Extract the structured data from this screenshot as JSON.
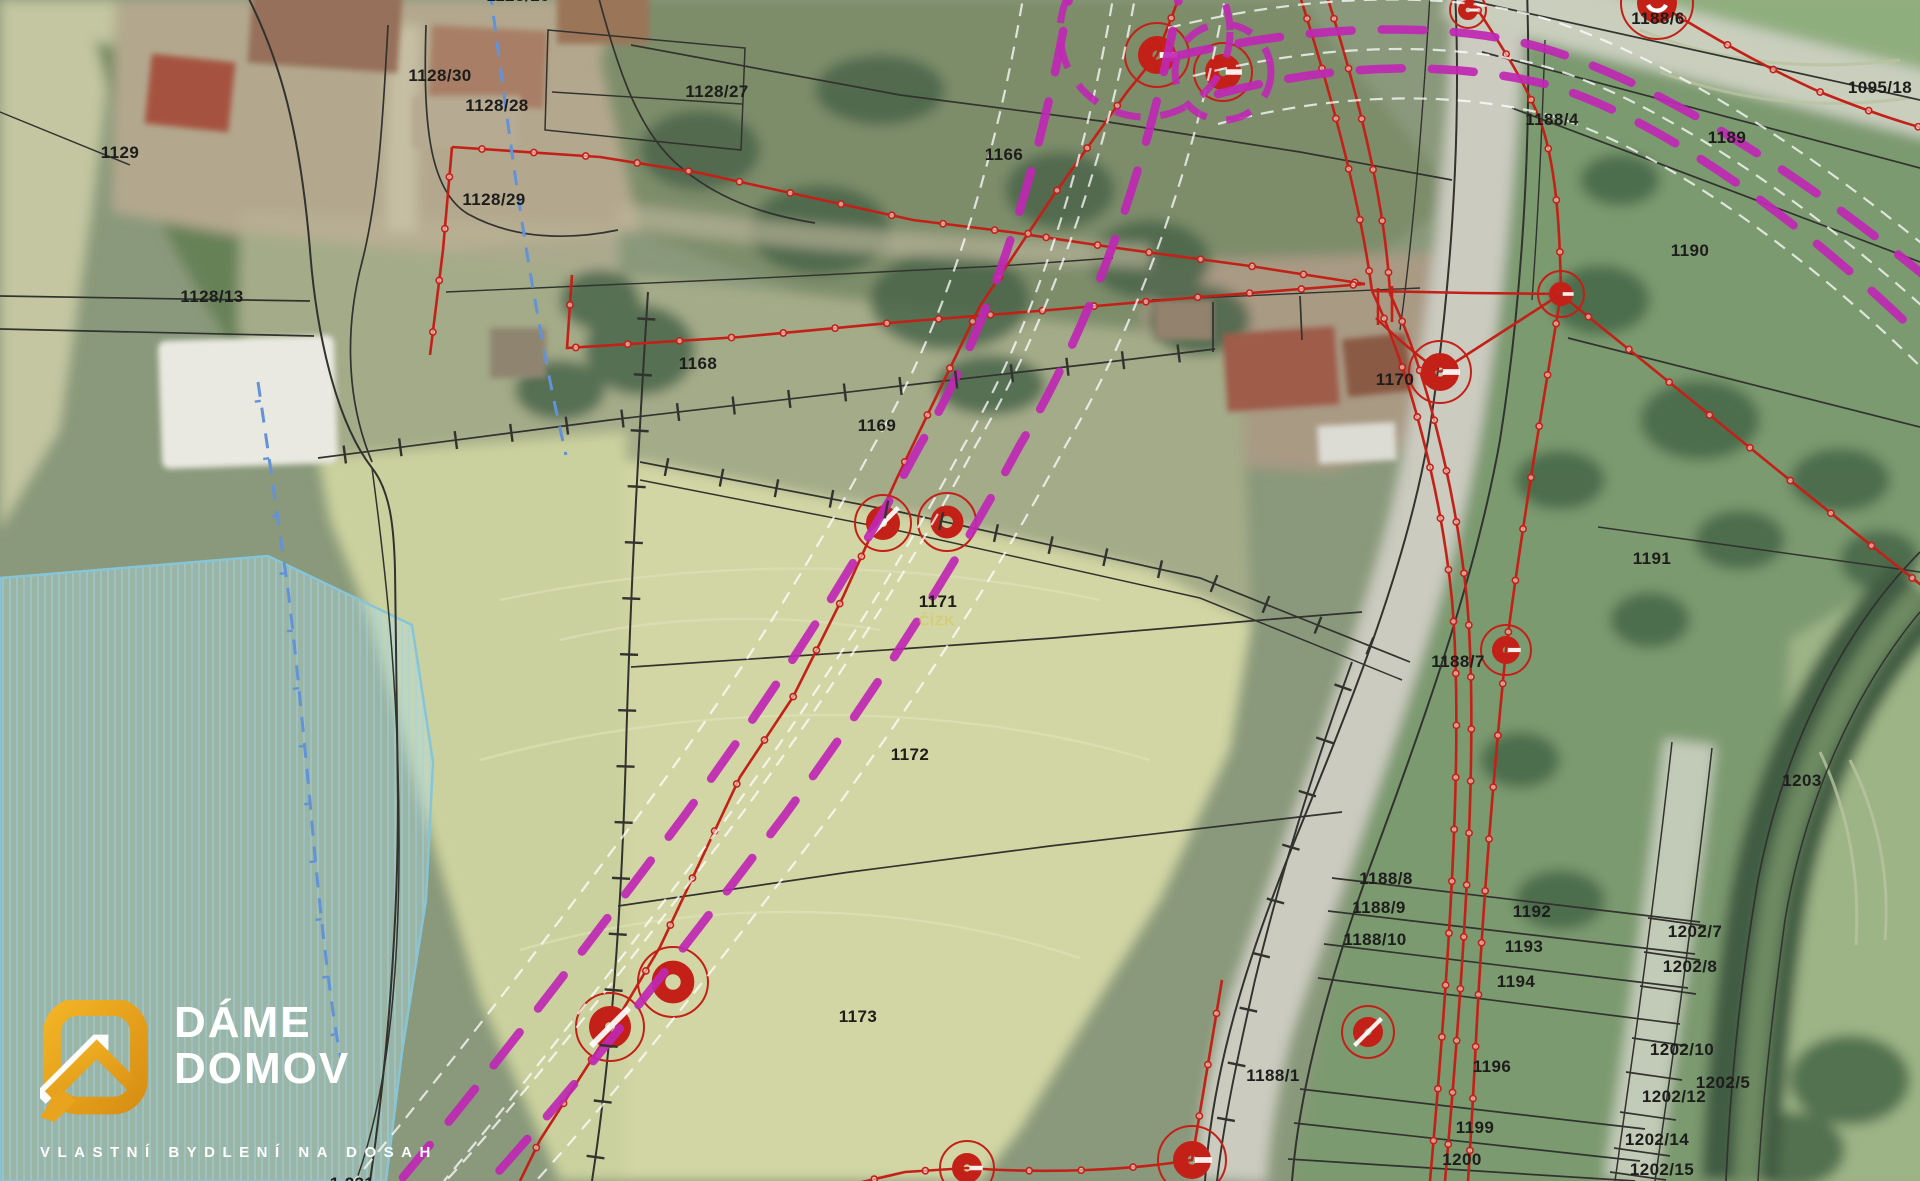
{
  "app": {
    "type": "cadastral-map-over-aerial-photo"
  },
  "colors": {
    "utility_red": "#c32017",
    "pipeline_magenta": "#bf28b4",
    "stream_blue": "#6292d8",
    "label_black": "#1d1d1b",
    "flood_zone_border": "#86c5d8",
    "logo_orange": "#e9a41f"
  },
  "watermark": {
    "brand_line1": "DÁME",
    "brand_line2": "DOMOV",
    "tagline": "VLASTNÍ BYDLENÍ NA DOSAH"
  },
  "map": {
    "parcel_labels": [
      {
        "text": "1129",
        "x": 120,
        "y": 153
      },
      {
        "text": "1128/30",
        "x": 440,
        "y": 76
      },
      {
        "text": "1128/28",
        "x": 497,
        "y": 106
      },
      {
        "text": "1128/27",
        "x": 717,
        "y": 92
      },
      {
        "text": "1128/29",
        "x": 494,
        "y": 200
      },
      {
        "text": "1128/13",
        "x": 212,
        "y": 297
      },
      {
        "text": "1166",
        "x": 1004,
        "y": 155
      },
      {
        "text": "1168",
        "x": 698,
        "y": 364
      },
      {
        "text": "1169",
        "x": 877,
        "y": 426
      },
      {
        "text": "1170",
        "x": 1395,
        "y": 380
      },
      {
        "text": "1171",
        "x": 938,
        "y": 602
      },
      {
        "text": "1172",
        "x": 910,
        "y": 755
      },
      {
        "text": "1173",
        "x": 858,
        "y": 1017
      },
      {
        "text": "1188/4",
        "x": 1552,
        "y": 120
      },
      {
        "text": "1188/6",
        "x": 1658,
        "y": 19
      },
      {
        "text": "1095/18",
        "x": 1880,
        "y": 88
      },
      {
        "text": "1189",
        "x": 1727,
        "y": 138
      },
      {
        "text": "1190",
        "x": 1690,
        "y": 251
      },
      {
        "text": "1191",
        "x": 1652,
        "y": 559
      },
      {
        "text": "1188/7",
        "x": 1458,
        "y": 662
      },
      {
        "text": "1203",
        "x": 1802,
        "y": 781
      },
      {
        "text": "1188/8",
        "x": 1386,
        "y": 879
      },
      {
        "text": "1188/9",
        "x": 1379,
        "y": 908
      },
      {
        "text": "1188/10",
        "x": 1375,
        "y": 940
      },
      {
        "text": "1192",
        "x": 1532,
        "y": 912
      },
      {
        "text": "1193",
        "x": 1524,
        "y": 947
      },
      {
        "text": "1194",
        "x": 1516,
        "y": 982
      },
      {
        "text": "1202/7",
        "x": 1695,
        "y": 932
      },
      {
        "text": "1202/8",
        "x": 1690,
        "y": 967
      },
      {
        "text": "1202/10",
        "x": 1682,
        "y": 1050
      },
      {
        "text": "1202/5",
        "x": 1723,
        "y": 1083
      },
      {
        "text": "1202/12",
        "x": 1674,
        "y": 1097
      },
      {
        "text": "1196",
        "x": 1492,
        "y": 1067
      },
      {
        "text": "1199",
        "x": 1475,
        "y": 1128
      },
      {
        "text": "1200",
        "x": 1462,
        "y": 1160
      },
      {
        "text": "1202/14",
        "x": 1657,
        "y": 1140
      },
      {
        "text": "1202/15",
        "x": 1662,
        "y": 1170
      },
      {
        "text": "1188/1",
        "x": 1273,
        "y": 1076
      },
      {
        "text": "1128/16",
        "x": 518,
        "y": -4
      },
      {
        "text": "1 231",
        "x": 352,
        "y": 1184
      }
    ],
    "faint_labels": [
      {
        "text": "ČÍZK",
        "x": 937,
        "y": 621
      }
    ],
    "well_symbols": [
      {
        "x": 1157,
        "y": 55,
        "t": "c",
        "dr": 19,
        "rr": 32
      },
      {
        "x": 1223,
        "y": 72,
        "t": "c",
        "dr": 18,
        "rr": 29
      },
      {
        "x": 1657,
        "y": 3,
        "t": "dot",
        "dr": 20,
        "rr": 36
      },
      {
        "x": 1468,
        "y": 10,
        "t": "c",
        "dr": 10,
        "rr": 18
      },
      {
        "x": 1561,
        "y": 294,
        "t": "c",
        "dr": 12,
        "rr": 23
      },
      {
        "x": 1440,
        "y": 372,
        "t": "c",
        "dr": 19,
        "rr": 31
      },
      {
        "x": 1506,
        "y": 650,
        "t": "c",
        "dr": 14,
        "rr": 25
      },
      {
        "x": 883,
        "y": 523,
        "t": "s",
        "dr": 17,
        "rr": 28
      },
      {
        "x": 947,
        "y": 522,
        "t": "o",
        "dr": 17,
        "rr": 29
      },
      {
        "x": 673,
        "y": 982,
        "t": "o",
        "dr": 22,
        "rr": 35
      },
      {
        "x": 610,
        "y": 1027,
        "t": "s",
        "dr": 21,
        "rr": 34
      },
      {
        "x": 1368,
        "y": 1032,
        "t": "s",
        "dr": 15,
        "rr": 26
      },
      {
        "x": 1192,
        "y": 1160,
        "t": "c",
        "dr": 19,
        "rr": 34
      },
      {
        "x": 967,
        "y": 1168,
        "t": "c",
        "dr": 15,
        "rr": 27
      }
    ]
  }
}
